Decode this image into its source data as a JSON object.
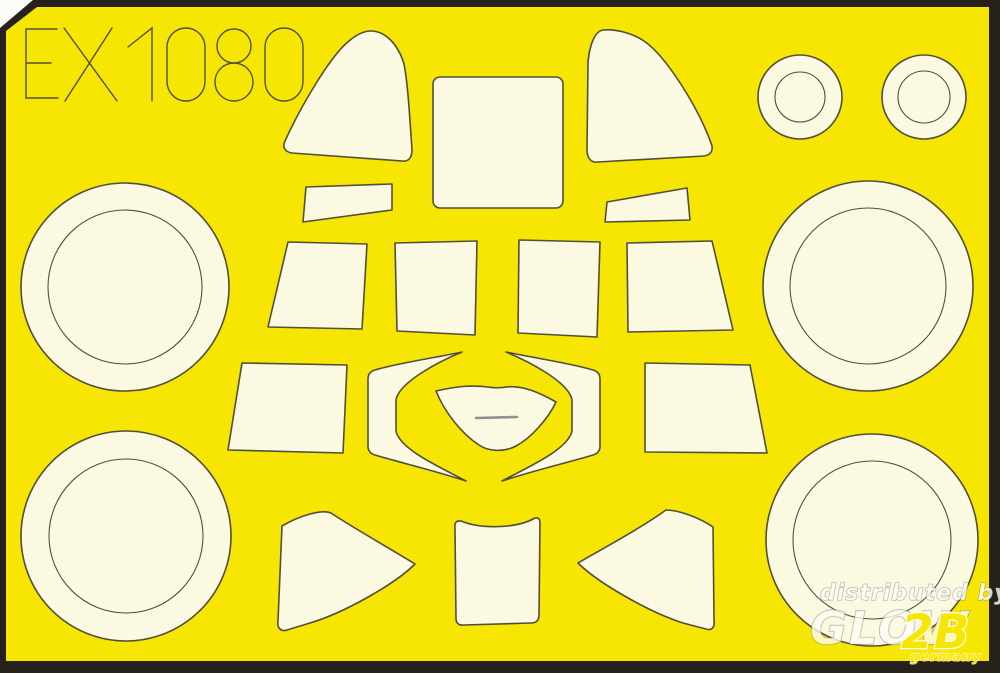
{
  "sheet": {
    "product_code": "EX1080",
    "colors": {
      "sheet_yellow": "#F7E503",
      "mask_cream": "#FCF9E2",
      "outline": "#50503A",
      "border_dark": "#26221B",
      "backing_white": "#FBFBF7",
      "detail_gray": "#8F9090"
    },
    "border": {
      "outer_points": "33,0 1000,0 1000,673 0,673 0,28",
      "inner_points": "37,7 989,7 989,661 6,661 6,31"
    },
    "code_glyphs": [
      "M57,29 L26,29 L26,98 L58,98 M26,63 L51,63",
      "M64,28 L117,101 M112,28 L65,101",
      "M128,47 L152,28 L152,101",
      "M186,28 C197,28 205,37 205,47 L205,81 C205,92 197,101 186,101 C175,101 167,92 167,81 L167,47 C167,37 175,28 186,28 Z",
      "M251,46 A17,17 0 1 1 217,46 A17,17 0 1 1 251,46 Z",
      "M253,82 A19,19 0 1 1 215,82 A19,19 0 1 1 253,82 Z",
      "M284,28 C295,28 303,37 303,47 L303,81 C303,92 295,101 284,101 C273,101 265,92 265,81 L265,47 C265,37 273,28 284,28 Z"
    ],
    "masks": [
      {
        "name": "mask-windscreen-left",
        "type": "path",
        "d": "M371,31 C385,31 398,44 404,64 C408,84 410,122 412,150 C412,158 408,162 402,161 L292,153 C285,152 282,147 285,141 C300,108 330,56 349,41 C356,35 364,31 371,31 Z"
      },
      {
        "name": "mask-canopy-top",
        "type": "rect",
        "x": 433,
        "y": 77,
        "w": 130,
        "h": 131,
        "rx": 7
      },
      {
        "name": "mask-windscreen-right",
        "type": "path",
        "d": "M604,30 C596,30 590,42 588,62 L587,150 C587,158 591,163 598,162 L704,156 C711,155 714,150 711,143 C698,107 666,56 644,41 C631,32 613,29 604,30 Z"
      },
      {
        "name": "mask-wheel-ring-small-left",
        "type": "ring",
        "cx": 800,
        "cy": 97,
        "r": 42,
        "ri": 25
      },
      {
        "name": "mask-wheel-ring-small-right",
        "type": "ring",
        "cx": 924,
        "cy": 97,
        "r": 42,
        "ri": 26
      },
      {
        "name": "mask-strip-left",
        "type": "path",
        "d": "M306,187 L392,184 L392,210 L303,222 Z"
      },
      {
        "name": "mask-strip-right",
        "type": "path",
        "d": "M607,202 L687,188 L690,220 L605,222 Z"
      },
      {
        "name": "mask-wheel-ring-top-left",
        "type": "ring",
        "cx": 125,
        "cy": 287,
        "r": 104,
        "ri": 77
      },
      {
        "name": "mask-wheel-ring-top-right",
        "type": "ring",
        "cx": 868,
        "cy": 286,
        "r": 105,
        "ri": 78
      },
      {
        "name": "mask-quarter-window-a",
        "type": "path",
        "d": "M288,242 L367,244 L362,329 L268,327 Z"
      },
      {
        "name": "mask-quarter-window-b",
        "type": "path",
        "d": "M395,243 L477,241 L475,335 L397,331 Z"
      },
      {
        "name": "mask-quarter-window-c",
        "type": "path",
        "d": "M519,240 L600,242 L597,337 L518,333 Z"
      },
      {
        "name": "mask-quarter-window-d",
        "type": "path",
        "d": "M627,243 L712,241 L733,330 L628,332 Z"
      },
      {
        "name": "mask-side-panel-left",
        "type": "path",
        "d": "M242,363 L347,365 L343,453 L228,450 Z"
      },
      {
        "name": "mask-bracket-left",
        "type": "path",
        "d": "M462,352 C434,358 398,363 375,370 Q368,372 368,379 L368,446 Q368,453 375,455 C398,462 436,471 466,481 C442,468 400,450 396,431 L396,400 C399,382 440,361 462,352 Z"
      },
      {
        "name": "mask-hub-center",
        "type": "path",
        "d": "M436,391 C458,386 472,385 488,387 C493,388 501,388 506,387 C524,385 542,394 556,402 C548,419 531,438 516,446 C505,452 489,452 479,445 C462,434 445,413 436,391 Z"
      },
      {
        "name": "mask-bracket-right",
        "type": "path",
        "d": "M506,352 C534,358 570,363 593,370 Q600,372 600,379 L600,446 Q600,453 593,455 C570,462 532,471 502,481 C526,468 568,450 572,431 L572,400 C569,382 528,361 506,352 Z"
      },
      {
        "name": "mask-side-panel-right",
        "type": "path",
        "d": "M645,363 L750,365 L767,453 L645,452 Z"
      },
      {
        "name": "mask-wheel-ring-bottom-left",
        "type": "ring",
        "cx": 126,
        "cy": 536,
        "r": 105,
        "ri": 77
      },
      {
        "name": "mask-wheel-ring-bottom-right",
        "type": "ring",
        "cx": 872,
        "cy": 540,
        "r": 106,
        "ri": 79
      },
      {
        "name": "mask-fin-left",
        "type": "path",
        "d": "M282,526 C299,516 321,509 331,513 C355,529 391,549 415,564 C395,584 344,613 310,623 L287,630 C281,632 277,628 278,621 Z"
      },
      {
        "name": "mask-panel-bottom-center",
        "type": "path",
        "d": "M461,521 C480,529 516,529 535,518 Q540,517 540,523 L539,615 Q539,623 531,623 L464,625 Q456,626 456,618 L455,528 Q454,520 461,521 Z"
      },
      {
        "name": "mask-fin-right",
        "type": "path",
        "d": "M713,527 C700,518 679,510 666,510 C641,528 602,549 578,563 C598,583 649,612 683,623 L706,629 C712,631 715,627 714,620 Z"
      }
    ],
    "details": [
      {
        "name": "hub-center-slit",
        "type": "line",
        "x1": 476,
        "y1": 418,
        "x2": 517,
        "y2": 417
      }
    ]
  },
  "watermark": {
    "line1": "distributed by",
    "brand": "GLOW",
    "brand_suffix": "2B",
    "country": "germany"
  }
}
